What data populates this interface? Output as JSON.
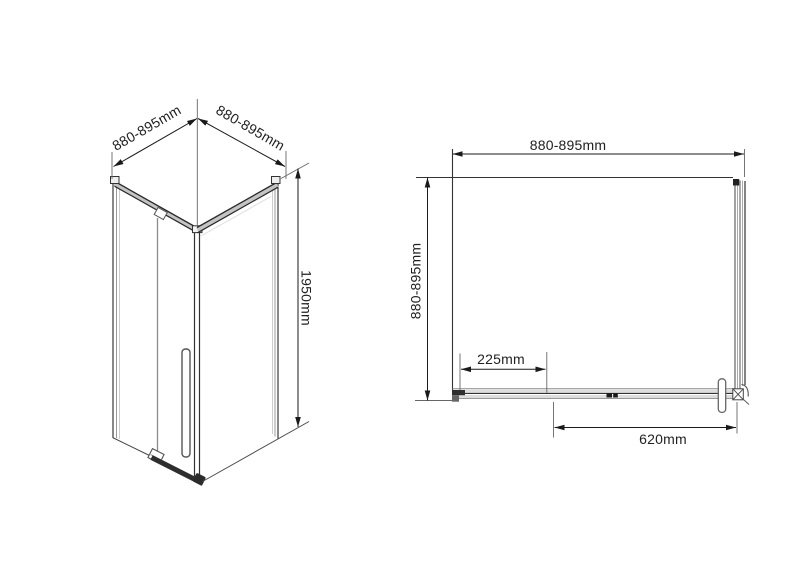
{
  "colors": {
    "background": "#ffffff",
    "line_dark": "#1a1a1a",
    "line_mid": "#555555",
    "line_light": "#aaaaaa"
  },
  "isometric_view": {
    "dim_width_left": "880-895mm",
    "dim_width_right": "880-895mm",
    "dim_height": "1950mm"
  },
  "plan_view": {
    "dim_width_top": "880-895mm",
    "dim_depth_left": "880-895mm",
    "dim_fixed_panel": "225mm",
    "dim_door_opening": "620mm"
  }
}
